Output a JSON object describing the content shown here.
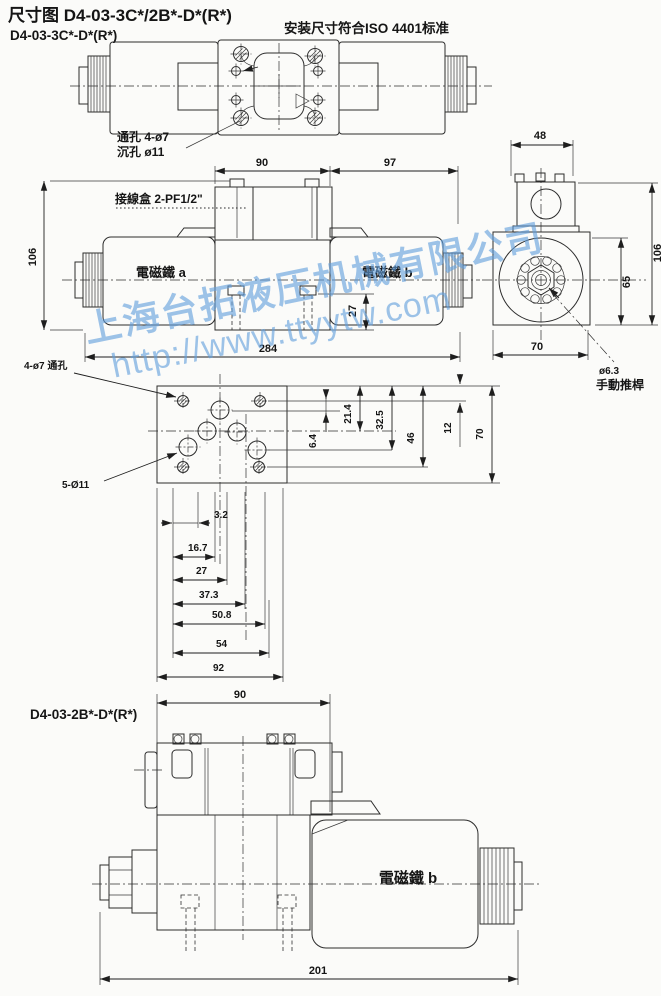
{
  "header": {
    "title": "尺寸图 D4-03-3C*/2B*-D*(R*)",
    "standard_note": "安装尺寸符合ISO 4401标准"
  },
  "watermark": {
    "company": "上海台拓液压机械有限公司",
    "url": "http://www.ttyytw.com",
    "color": "#619EDB"
  },
  "valve_3c": {
    "model_label": "D4-03-3C*-D*(R*)",
    "top_view": {
      "through_hole_note": "通孔 4-ø7",
      "counterbore_note": "沉孔 ø11"
    },
    "front_view": {
      "junction_box_label": "接線盒 2-PF1/2\"",
      "solenoid_a_label": "電磁鐵 a",
      "solenoid_b_label": "電磁鐵 b",
      "dim_width_left": "90",
      "dim_width_right": "97",
      "dim_height": "106",
      "dim_plug_height": "27",
      "dim_total_length": "284"
    },
    "side_view": {
      "dim_top_width": "48",
      "dim_height": "106",
      "dim_body_height": "65",
      "dim_body_width": "70",
      "manual_pin_dia": "ø6.3",
      "manual_pin_label": "手動推桿"
    },
    "mounting_pattern": {
      "through_holes_note": "4-ø7 通孔",
      "port_holes_note": "5-Ø11",
      "vertical_dims": [
        "6.4",
        "21.4",
        "32.5",
        "46",
        "12",
        "70"
      ],
      "horizontal_dims": [
        "3.2",
        "16.7",
        "27",
        "37.3",
        "50.8",
        "54",
        "92"
      ]
    }
  },
  "valve_2b": {
    "model_label": "D4-03-2B*-D*(R*)",
    "solenoid_b_label": "電磁鐵 b",
    "dim_top_width": "90",
    "dim_total_length": "201"
  }
}
